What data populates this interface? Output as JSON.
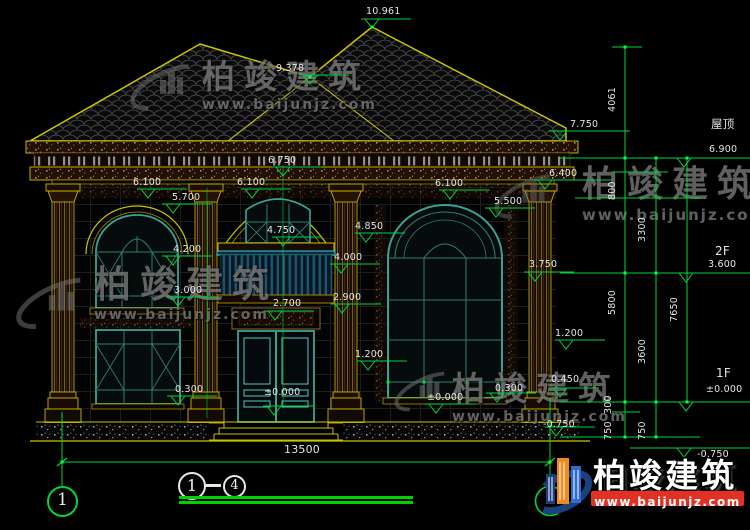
{
  "drawing": {
    "title": {
      "axis_start": "1",
      "axis_end": "4",
      "name": "轴立面图",
      "scale": "1:100"
    },
    "axis_bubble_bottom_left": "1",
    "dimension_labels": [
      {
        "text": "10.961",
        "x": 366,
        "y": 7
      },
      {
        "text": "9.378",
        "x": 276,
        "y": 64
      },
      {
        "text": "7.750",
        "x": 570,
        "y": 120
      },
      {
        "text": "屋顶",
        "x": 711,
        "y": 119,
        "size": 11.5
      },
      {
        "text": "6.900",
        "x": 709,
        "y": 145
      },
      {
        "text": "6.750",
        "x": 268,
        "y": 156
      },
      {
        "text": "6.100",
        "x": 133,
        "y": 178
      },
      {
        "text": "6.100",
        "x": 237,
        "y": 178
      },
      {
        "text": "6.100",
        "x": 435,
        "y": 179
      },
      {
        "text": "6.400",
        "x": 549,
        "y": 169
      },
      {
        "text": "5.700",
        "x": 172,
        "y": 193
      },
      {
        "text": "5.500",
        "x": 494,
        "y": 197
      },
      {
        "text": "4.850",
        "x": 355,
        "y": 222
      },
      {
        "text": "4.750",
        "x": 267,
        "y": 226
      },
      {
        "text": "4.200",
        "x": 173,
        "y": 245
      },
      {
        "text": "4.000",
        "x": 334,
        "y": 253
      },
      {
        "text": "3.750",
        "x": 529,
        "y": 260
      },
      {
        "text": "3.000",
        "x": 174,
        "y": 286
      },
      {
        "text": "2.900",
        "x": 333,
        "y": 293
      },
      {
        "text": "2.700",
        "x": 273,
        "y": 299
      },
      {
        "text": "1.200",
        "x": 555,
        "y": 329
      },
      {
        "text": "1.200",
        "x": 355,
        "y": 350
      },
      {
        "text": "0.300",
        "x": 175,
        "y": 385
      },
      {
        "text": "±0.000",
        "x": 264,
        "y": 388
      },
      {
        "text": "±0.000",
        "x": 427,
        "y": 393
      },
      {
        "text": "0.300",
        "x": 495,
        "y": 384
      },
      {
        "text": "0.450",
        "x": 551,
        "y": 375
      },
      {
        "text": "-0.750",
        "x": 543,
        "y": 420
      },
      {
        "text": "-0.750",
        "x": 697,
        "y": 450
      },
      {
        "text": "13500",
        "x": 284,
        "y": 444,
        "size": 11
      },
      {
        "text": "2F",
        "x": 715,
        "y": 245,
        "size": 12
      },
      {
        "text": "3.600",
        "x": 708,
        "y": 260
      },
      {
        "text": "1F",
        "x": 716,
        "y": 367,
        "size": 12
      },
      {
        "text": "±0.000",
        "x": 706,
        "y": 385
      },
      {
        "text": "4061",
        "x": 608,
        "y": 112,
        "rot": true
      },
      {
        "text": "800",
        "x": 608,
        "y": 200,
        "rot": true
      },
      {
        "text": "3300",
        "x": 638,
        "y": 242,
        "rot": true
      },
      {
        "text": "5800",
        "x": 608,
        "y": 315,
        "rot": true
      },
      {
        "text": "7650",
        "x": 670,
        "y": 322,
        "rot": true
      },
      {
        "text": "3600",
        "x": 638,
        "y": 364,
        "rot": true
      },
      {
        "text": "300",
        "x": 604,
        "y": 414,
        "rot": true
      },
      {
        "text": "750",
        "x": 604,
        "y": 440,
        "rot": true
      },
      {
        "text": "750",
        "x": 638,
        "y": 440,
        "rot": true
      }
    ]
  },
  "watermark": {
    "brand": "柏竣建筑",
    "site": "www.baijunjz.com",
    "instances": [
      {
        "x": 202,
        "y": 60,
        "brand_size": 33,
        "site_size": 14
      },
      {
        "x": 582,
        "y": 166,
        "brand_size": 36,
        "site_size": 15
      },
      {
        "x": 94,
        "y": 266,
        "brand_size": 37,
        "site_size": 14
      },
      {
        "x": 452,
        "y": 372,
        "brand_size": 33,
        "site_size": 14
      }
    ]
  },
  "logo": {
    "brand": "柏竣建筑",
    "site": "www.baijunjz.com"
  },
  "colors": {
    "annotation_green": "#00d53a",
    "cad_yellow": "#cbc400",
    "window_teal": "#3da295",
    "underline_green": "#00d400",
    "logo_red": "#e23122",
    "logo_orange": "#ef8a1c",
    "logo_blue": "#2f6bd0",
    "logo_navy": "#1c3f80"
  }
}
